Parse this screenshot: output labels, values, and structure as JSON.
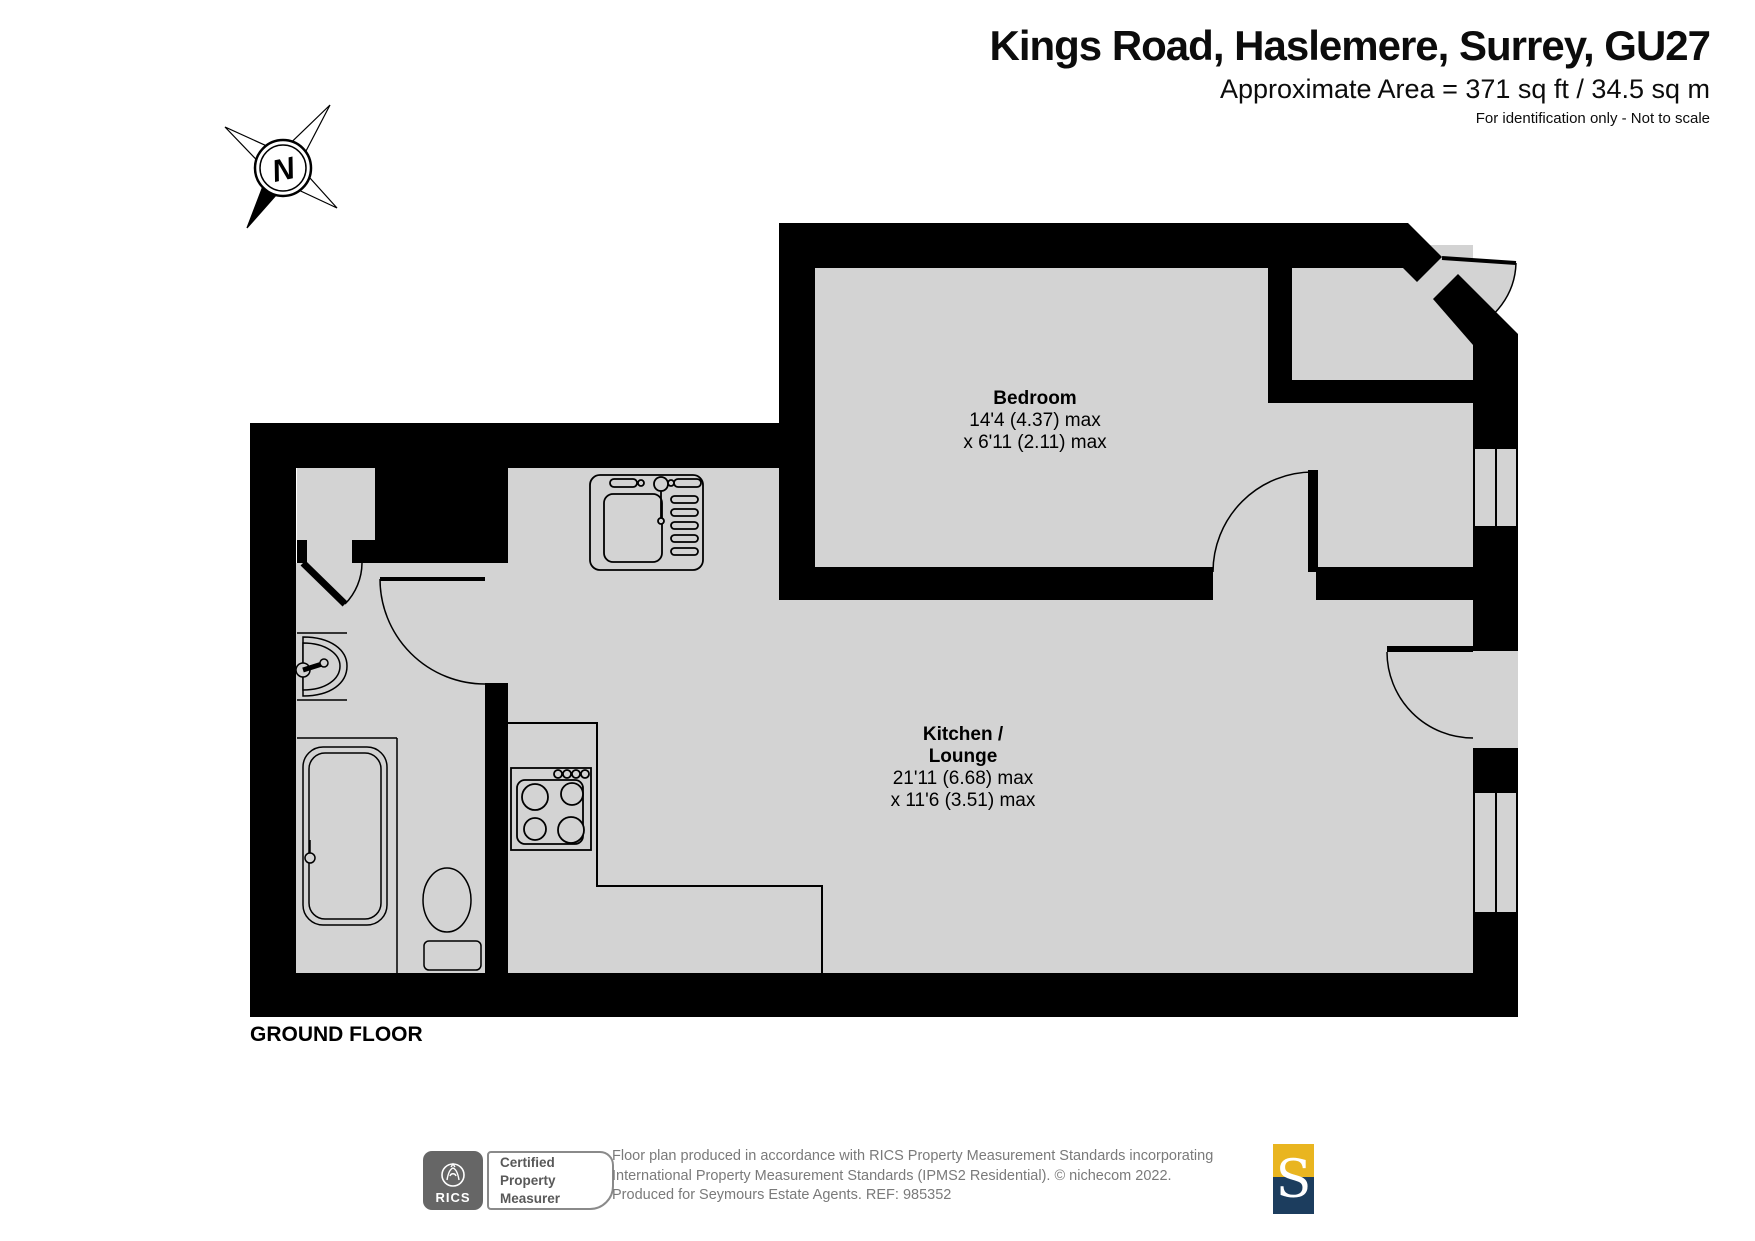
{
  "header": {
    "title": "Kings Road, Haslemere, Surrey, GU27",
    "area": "Approximate Area = 371 sq ft / 34.5 sq m",
    "note": "For identification only - Not to scale"
  },
  "compass": {
    "letter": "N"
  },
  "plan": {
    "floor_label": "GROUND FLOOR",
    "bedroom": {
      "name": "Bedroom",
      "dim1": "14'4 (4.37) max",
      "dim2": "x 6'11 (2.11) max"
    },
    "kitchen": {
      "name1": "Kitchen /",
      "name2": "Lounge",
      "dim1": "21'11 (6.68) max",
      "dim2": "x 11'6 (3.51) max"
    }
  },
  "footer": {
    "rics": {
      "brand": "RICS"
    },
    "certified": {
      "line1": "Certified",
      "line2": "Property",
      "line3": "Measurer"
    },
    "disclaimer": {
      "line1": "Floor plan produced in accordance with RICS Property Measurement Standards incorporating",
      "line2": "International Property Measurement Standards (IPMS2 Residential).   © nichecom 2022.",
      "line3": "Produced for Seymours Estate Agents.   REF: 985352"
    },
    "seymours": {
      "letter": "S"
    }
  },
  "colors": {
    "floor": "#d3d3d3",
    "wall": "#000000",
    "logo_gray": "#666666",
    "text_gray": "#7a7a7a",
    "accent_gold": "#e9b520",
    "accent_navy": "#1c3d5e"
  }
}
